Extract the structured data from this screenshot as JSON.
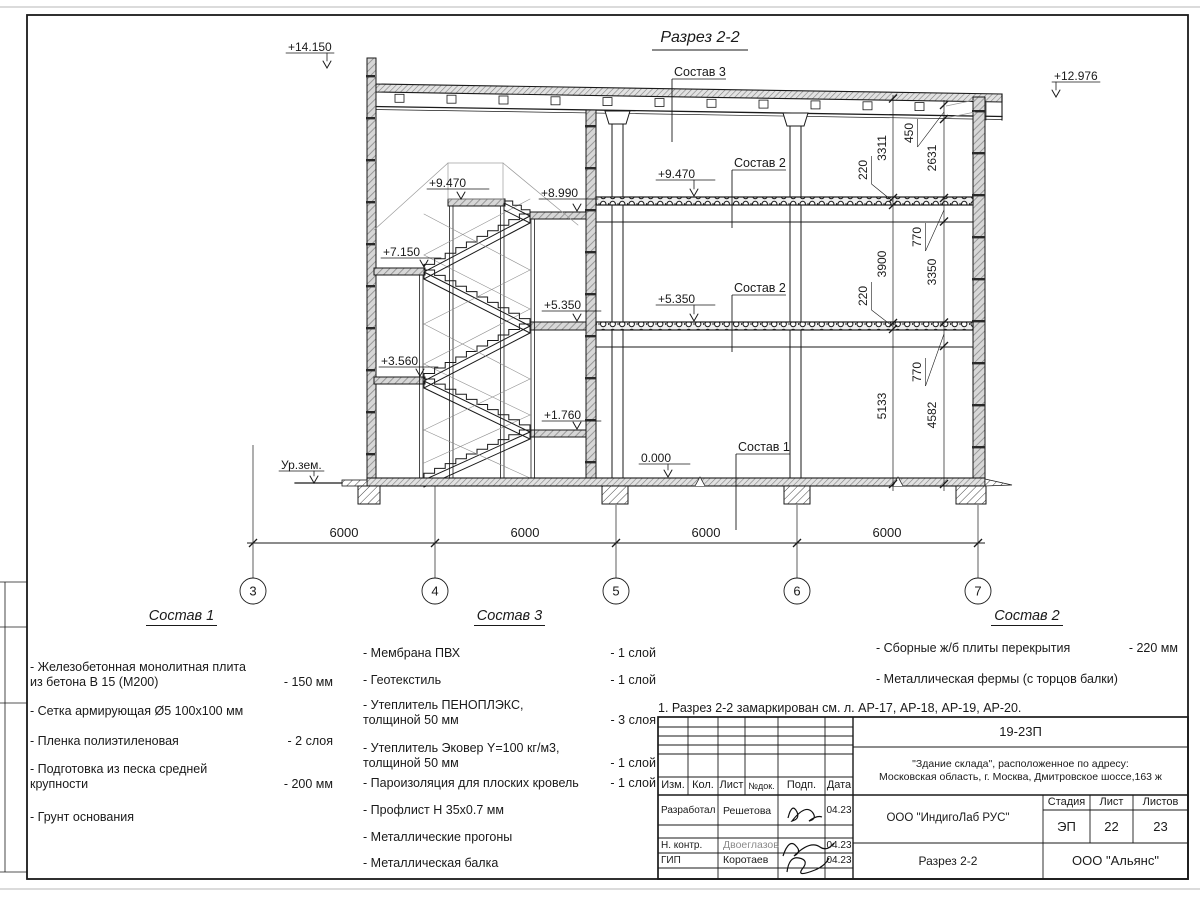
{
  "drawing": {
    "title": "Разрез 2-2",
    "elev": {
      "e14": "+14.150",
      "e12": "+12.976",
      "e947": "+9.470",
      "e899": "+8.990",
      "e715": "+7.150",
      "e535": "+5.350",
      "e356": "+3.560",
      "e176": "+1.760",
      "e0": "0.000",
      "ground": "Ур.зем."
    },
    "callout1": "Состав 1",
    "callout2": "Состав 2",
    "callout3": "Состав 3",
    "dims": {
      "span": "6000",
      "d3311": "3311",
      "d220": "220",
      "d3900": "3900",
      "d5133": "5133",
      "d450": "450",
      "d2631": "2631",
      "d770": "770",
      "d3350": "3350",
      "d4582": "4582"
    },
    "grids": [
      "3",
      "4",
      "5",
      "6",
      "7"
    ]
  },
  "legend1": {
    "title": "Состав 1",
    "items": [
      {
        "text": "- Железобетонная  монолитная плита\nиз бетона В 15 (М200)",
        "value": "- 150 мм"
      },
      {
        "text": "- Сетка армирующая Ø5 100х100 мм",
        "value": ""
      },
      {
        "text": "- Пленка полиэтиленовая",
        "value": "-  2 слоя"
      },
      {
        "text": "- Подготовка из песка средней\nкрупности",
        "value": "- 200 мм"
      },
      {
        "text": "- Грунт основания",
        "value": ""
      }
    ]
  },
  "legend3": {
    "title": "Состав 3",
    "items": [
      {
        "text": "- Мембрана ПВХ",
        "value": "- 1 слой"
      },
      {
        "text": "- Геотекстиль",
        "value": "- 1 слой"
      },
      {
        "text": "- Утеплитель ПЕНОПЛЭКС,\nтолщиной 50 мм",
        "value": "- 3 слоя"
      },
      {
        "text": "- Утеплитель Эковер Y=100 кг/м3,\nтолщиной 50 мм",
        "value": "- 1 слой"
      },
      {
        "text": "- Пароизоляция для плоских кровель",
        "value": "- 1 слой"
      },
      {
        "text": "- Профлист Н 35х0.7 мм",
        "value": ""
      },
      {
        "text": "- Металлические прогоны",
        "value": ""
      },
      {
        "text": "- Металлическая балка",
        "value": ""
      }
    ]
  },
  "legend2": {
    "title": "Состав 2",
    "items": [
      {
        "text": "- Сборные ж/б плиты перекрытия",
        "value": "- 220 мм"
      },
      {
        "text": "- Металлическая фермы (с торцов балки)",
        "value": ""
      }
    ]
  },
  "note": "1. Разрез 2-2 замаркирован см. л. АР-17, АР-18, АР-19, АР-20.",
  "titleblock": {
    "doc_number": "19-23П",
    "object": "\"Здание склада\", расположенное по адресу:\nМосковская область, г. Москва, Дмитровское шоссе,163 ж",
    "header": {
      "izm": "Изм.",
      "kol": "Кол.",
      "list": "Лист",
      "ndok": "№док.",
      "podp": "Подп.",
      "data": "Дата"
    },
    "rows": [
      {
        "role": "Разработал",
        "name": "Решетова",
        "date": "04.23"
      },
      {
        "role": "Н. контр.",
        "name": "Двоеглазов",
        "date": "04.23"
      },
      {
        "role": "ГИП",
        "name": "Коротаев",
        "date": "04.23"
      }
    ],
    "org1": "ООО \"ИндигоЛаб РУС\"",
    "stage_label": "Стадия",
    "list_label": "Лист",
    "listov_label": "Листов",
    "stage": "ЭП",
    "list": "22",
    "listov": "23",
    "sheet_title": "Разрез 2-2",
    "org2": "ООО \"Альянс\""
  }
}
